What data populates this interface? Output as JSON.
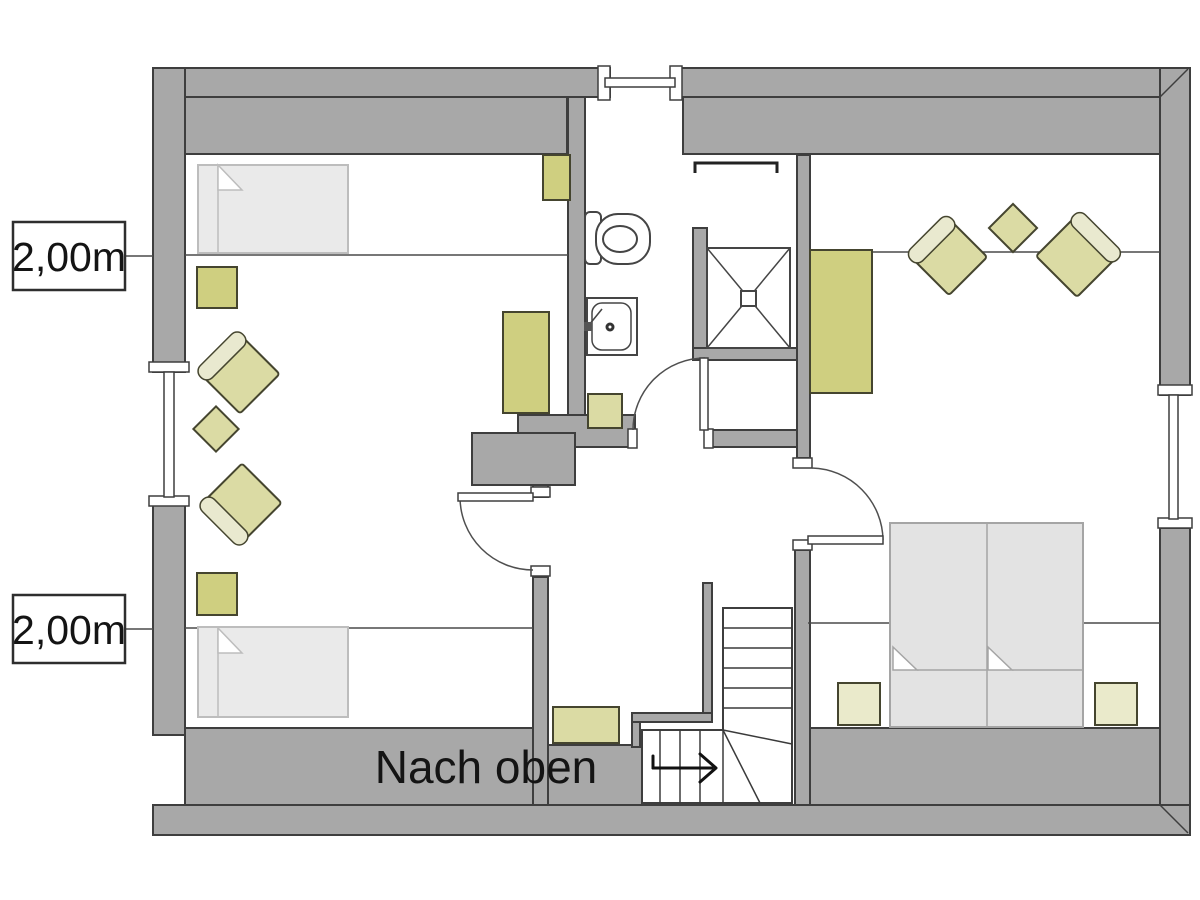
{
  "labels": {
    "height_marker_top": "2,00m",
    "height_marker_bottom": "2,00m",
    "stair_direction": "Nach oben"
  },
  "plan": {
    "type": "floor-plan",
    "floor_hint": "attic storey with sloped-roof height lines",
    "features": [
      "exterior-walls",
      "windows",
      "interior-doors",
      "chimney-block",
      "winder-staircase",
      "height-lines-2m"
    ],
    "rooms": {
      "left_room": [
        "single-bed",
        "nightstand",
        "armchair",
        "side-table",
        "armchair",
        "nightstand",
        "single-bed",
        "wardrobe",
        "shelf"
      ],
      "bathroom": [
        "toilet",
        "washbasin",
        "shower",
        "towel-rail",
        "cabinet"
      ],
      "right_room": [
        "sideboard",
        "armchair",
        "side-table",
        "armchair",
        "double-bed",
        "nightstand",
        "nightstand"
      ],
      "hall": [
        "shelf",
        "staircase-up"
      ]
    }
  },
  "colors": {
    "bg": "#ffffff",
    "wall": "#a8a8a8",
    "wall_outline": "#3e3e3e",
    "line": "#4a4a4a",
    "furniture": "#cfcf80",
    "furniture_light": "#dbdba4",
    "furniture_pale": "#eaeacb",
    "cushion": "#e9e9cf",
    "furniture_stroke": "#45452f",
    "bed_fill": "#eaeaea",
    "bed_stroke": "#bdbdbd",
    "bed2_fill": "#e3e3e3",
    "bed2_stroke": "#a5a5a5",
    "arrow": "#111111",
    "text": "#141414"
  }
}
